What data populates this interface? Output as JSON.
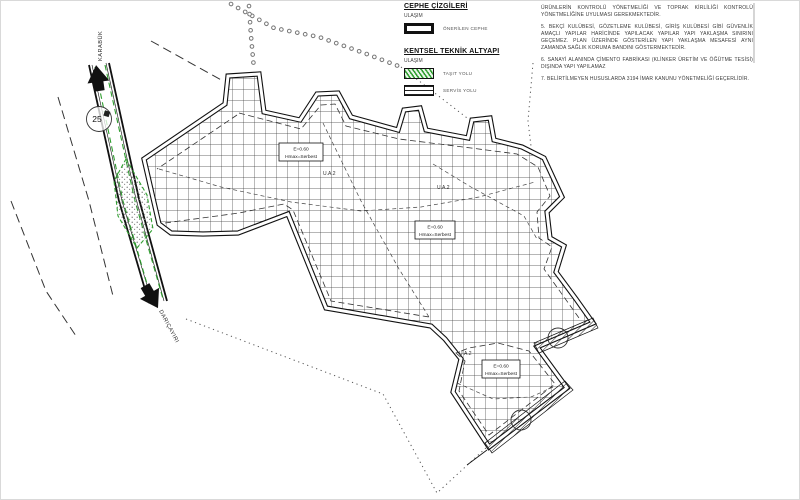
{
  "colors": {
    "ink": "#1d1d1d",
    "road_green": "#2f9e2f",
    "grid_line": "#3c3c3c",
    "muted_text": "#555555"
  },
  "legend": {
    "cephe_title": "CEPHE ÇİZGİLERİ",
    "cephe_sub": "ULAŞIM",
    "onerilen_cephe": "ÖNERİLEN CEPHE",
    "altyapi_title": "KENTSEL TEKNİK ALTYAPI",
    "altyapi_sub": "ULAŞIM",
    "tasit_yolu": "TAŞIT YOLU",
    "servis_yolu": "SERVİS YOLU"
  },
  "notes": {
    "lines": [
      "ÜRÜNLERİN KONTROLÜ YÖNETMELİĞİ VE TOPRAK KİRLİLİĞİ KONTROLÜ YÖNETMELİĞİNE UYULMASI GEREKMEKTEDİR.",
      "5. BEKÇİ KULÜBESİ, GÖZETLEME KULÜBESİ, GİRİŞ KULÜBESİ GİBİ GÜVENLİK AMAÇLI YAPILAR HARİCİNDE YAPILACAK YAPILAR YAPI YAKLAŞMA SINIRINI GEÇEMEZ. PLAN ÜZERİNDE GÖSTERİLEN YAPI YAKLAŞMA MESAFESİ AYNI ZAMANDA SAĞLIK KORUMA BANDINI GÖSTERMEKTEDİR.",
      "6. SANAYİ ALANINDA ÇİMENTO FABRİKASI (KLİNKER ÜRETİM VE ÖĞÜTME TESİSİ) DIŞINDA YAPI YAPILAMAZ",
      "7. BELİRTİLMEYEN HUSUSLARDA 3194 İMAR KANUNU YÖNETMELİĞİ GEÇERLİDİR."
    ]
  },
  "map": {
    "road_dest_top": "KARABÜK",
    "road_dest_bottom": "DARIÇAYIRI",
    "road_number": "25",
    "zone_code": "U.A.2",
    "density": {
      "line1": "E=0.60",
      "line2": "Hmax=Serbest"
    }
  }
}
